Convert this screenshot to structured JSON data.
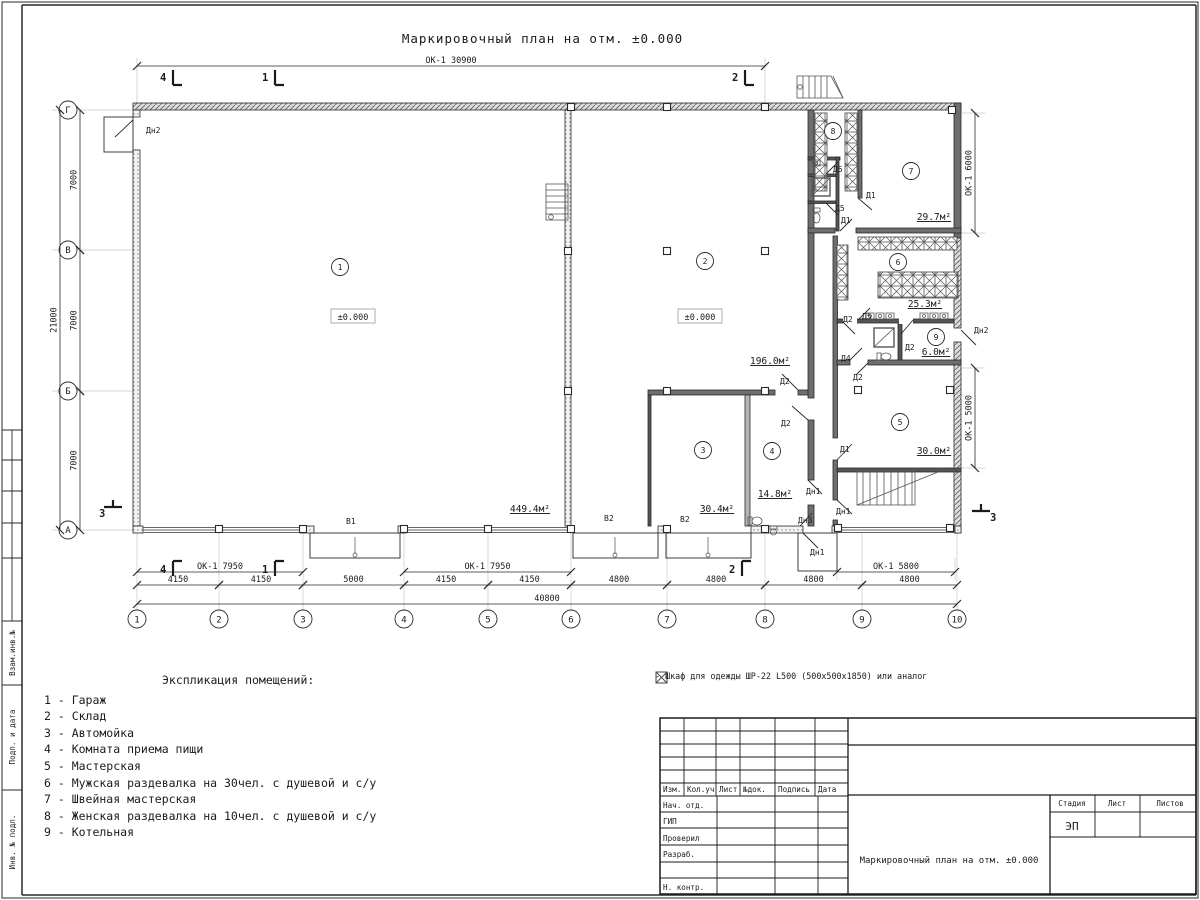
{
  "plan": {
    "title": "Маркировочный план на отм. ±0.000",
    "axes_bottom": [
      {
        "n": "1",
        "x": 137
      },
      {
        "n": "2",
        "x": 219
      },
      {
        "n": "3",
        "x": 303
      },
      {
        "n": "4",
        "x": 404
      },
      {
        "n": "5",
        "x": 488
      },
      {
        "n": "6",
        "x": 571
      },
      {
        "n": "7",
        "x": 667
      },
      {
        "n": "8",
        "x": 765
      },
      {
        "n": "9",
        "x": 862
      },
      {
        "n": "10",
        "x": 957
      }
    ],
    "axes_left": [
      {
        "n": "Г",
        "y": 110
      },
      {
        "n": "В",
        "y": 250
      },
      {
        "n": "Б",
        "y": 391
      },
      {
        "n": "А",
        "y": 530
      }
    ],
    "dims": [
      {
        "x1": 137,
        "x2": 765,
        "y": 66,
        "t": "ОК-1 30900"
      },
      {
        "x1": 137,
        "x2": 303,
        "y": 572,
        "t": "ОК-1 7950"
      },
      {
        "x1": 404,
        "x2": 571,
        "y": 572,
        "t": "ОК-1 7950"
      },
      {
        "x1": 837,
        "x2": 955,
        "y": 572,
        "t": "ОК-1 5800"
      },
      {
        "x1": 137,
        "x2": 219,
        "y": 585,
        "t": "4150"
      },
      {
        "x1": 219,
        "x2": 303,
        "y": 585,
        "t": "4150"
      },
      {
        "x1": 303,
        "x2": 404,
        "y": 585,
        "t": "5000"
      },
      {
        "x1": 404,
        "x2": 488,
        "y": 585,
        "t": "4150"
      },
      {
        "x1": 488,
        "x2": 571,
        "y": 585,
        "t": "4150"
      },
      {
        "x1": 571,
        "x2": 667,
        "y": 585,
        "t": "4800"
      },
      {
        "x1": 667,
        "x2": 765,
        "y": 585,
        "t": "4800"
      },
      {
        "x1": 765,
        "x2": 862,
        "y": 585,
        "t": "4800"
      },
      {
        "x1": 862,
        "x2": 957,
        "y": 585,
        "t": "4800"
      },
      {
        "x1": 137,
        "x2": 957,
        "y": 604,
        "t": "40800"
      },
      {
        "v": 1,
        "x": 80,
        "y1": 110,
        "y2": 250,
        "t": "7000"
      },
      {
        "v": 1,
        "x": 80,
        "y1": 250,
        "y2": 391,
        "t": "7000"
      },
      {
        "v": 1,
        "x": 80,
        "y1": 391,
        "y2": 530,
        "t": "7000"
      },
      {
        "v": 1,
        "x": 60,
        "y1": 110,
        "y2": 530,
        "t": "21000"
      },
      {
        "v": 1,
        "x": 975,
        "y1": 113,
        "y2": 233,
        "t": "ОК-1 6000"
      },
      {
        "v": 1,
        "x": 975,
        "y1": 368,
        "y2": 468,
        "t": "ОК-1 5000"
      }
    ],
    "rooms": [
      {
        "n": "1",
        "x": 340,
        "y": 267
      },
      {
        "n": "2",
        "x": 705,
        "y": 261
      },
      {
        "n": "3",
        "x": 703,
        "y": 450
      },
      {
        "n": "4",
        "x": 772,
        "y": 451
      },
      {
        "n": "5",
        "x": 900,
        "y": 422
      },
      {
        "n": "6",
        "x": 898,
        "y": 262
      },
      {
        "n": "7",
        "x": 911,
        "y": 171
      },
      {
        "n": "8",
        "x": 833,
        "y": 131
      },
      {
        "n": "9",
        "x": 936,
        "y": 337
      }
    ],
    "areas": [
      {
        "t": "449.4м²",
        "x": 530,
        "y": 512
      },
      {
        "t": "196.0м²",
        "x": 770,
        "y": 364
      },
      {
        "t": "30.4м²",
        "x": 717,
        "y": 512
      },
      {
        "t": "14.8м²",
        "x": 775,
        "y": 497
      },
      {
        "t": "30.0м²",
        "x": 934,
        "y": 454
      },
      {
        "t": "6.0м²",
        "x": 936,
        "y": 355
      },
      {
        "t": "25.3м²",
        "x": 925,
        "y": 307
      },
      {
        "t": "29.7м²",
        "x": 934,
        "y": 220
      }
    ],
    "levels": [
      {
        "t": "±0.000",
        "x": 353,
        "y": 320
      },
      {
        "t": "±0.000",
        "x": 700,
        "y": 320
      }
    ],
    "door_labels": [
      {
        "t": "Дн2",
        "x": 146,
        "y": 133
      },
      {
        "t": "В1",
        "x": 346,
        "y": 524
      },
      {
        "t": "В2",
        "x": 604,
        "y": 521
      },
      {
        "t": "В2",
        "x": 680,
        "y": 522
      },
      {
        "t": "Д2",
        "x": 780,
        "y": 384
      },
      {
        "t": "Д2",
        "x": 781,
        "y": 426
      },
      {
        "t": "Д1",
        "x": 840,
        "y": 452
      },
      {
        "t": "Дн1",
        "x": 806,
        "y": 494
      },
      {
        "t": "Дн1",
        "x": 836,
        "y": 514
      },
      {
        "t": "Дн3",
        "x": 798,
        "y": 523
      },
      {
        "t": "Дн1",
        "x": 810,
        "y": 555
      },
      {
        "t": "Д5",
        "x": 833,
        "y": 172
      },
      {
        "t": "Д1",
        "x": 866,
        "y": 198
      },
      {
        "t": "Д5",
        "x": 835,
        "y": 211
      },
      {
        "t": "Д1",
        "x": 841,
        "y": 223
      },
      {
        "t": "Д5",
        "x": 862,
        "y": 319
      },
      {
        "t": "Д2",
        "x": 843,
        "y": 322
      },
      {
        "t": "Дн2",
        "x": 974,
        "y": 333
      },
      {
        "t": "Д2",
        "x": 905,
        "y": 350
      },
      {
        "t": "Д4",
        "x": 841,
        "y": 361
      },
      {
        "t": "Д2",
        "x": 853,
        "y": 380
      }
    ],
    "section_marks": [
      {
        "n": "4",
        "x": 160,
        "y": 81
      },
      {
        "n": "1",
        "x": 262,
        "y": 81
      },
      {
        "n": "2",
        "x": 732,
        "y": 81
      },
      {
        "n": "4",
        "x": 160,
        "y": 573
      },
      {
        "n": "1",
        "x": 262,
        "y": 573
      },
      {
        "n": "2",
        "x": 729,
        "y": 573
      },
      {
        "n": "3",
        "x": 99,
        "y": 517
      },
      {
        "n": "3",
        "x": 990,
        "y": 521
      }
    ]
  },
  "legend": {
    "title": "Экспликация помещений:",
    "items": [
      "1 - Гараж",
      "2 - Склад",
      "3 - Автомойка",
      "4 - Комната приема пищи",
      "5 - Мастерская",
      "6 - Мужская раздевалка на 30чел. с душевой и с/у",
      "7 - Швейная мастерская",
      "8 - Женская раздевалка на 10чел. с душевой и с/у",
      "9 - Котельная"
    ]
  },
  "note": {
    "text": "- Шкаф для одежды ШР-22 L500 (500x500x1850) или аналог"
  },
  "titleblock": {
    "revision_cols": [
      "Изм.",
      "Кол.уч",
      "Лист",
      "№док.",
      "Подпись",
      "Дата"
    ],
    "staff_rows": [
      "Нач. отд.",
      "ГИП",
      "Проверил",
      "Разраб.",
      "Н. контр."
    ],
    "stage_header": "Стадия",
    "sheet_header": "Лист",
    "sheets_header": "Листов",
    "stage_value": "ЭП",
    "doc_title": "Маркировочный план на отм. ±0.000"
  },
  "side_stamp": {
    "labels": [
      "Взам.инв.№",
      "Подп. и дата",
      "Инв. № подл."
    ]
  }
}
